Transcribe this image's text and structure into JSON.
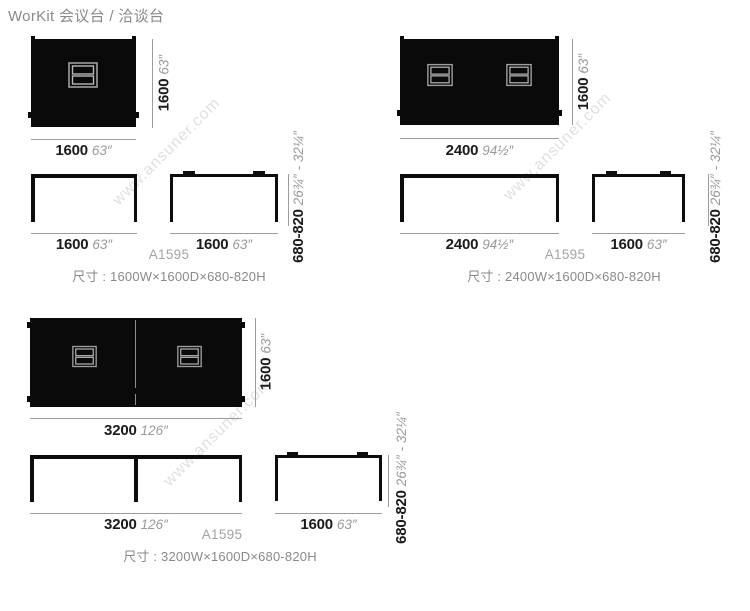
{
  "page_title": "WorKit 会议台 / 洽谈台",
  "watermark": "www.ansuner.com",
  "colors": {
    "table_black": "#0a0a0a",
    "dim_number": "#1b1b1b",
    "dim_inches_gray": "#9a9a9a",
    "dim_line_gray": "#9c9c9c",
    "label_gray": "#8a8a8a",
    "model_gray": "#a5a2a2",
    "port_stroke": "#9f9f9f"
  },
  "products": [
    {
      "model": "A1595",
      "spec": "尺寸 : 1600W×1600D×680-820H",
      "top": {
        "width_mm": "1600",
        "width_in": "63″",
        "depth_mm": "1600",
        "depth_in": "63″"
      },
      "front": {
        "width_mm": "1600",
        "width_in": "63″"
      },
      "side": {
        "width_mm": "1600",
        "width_in": "63″"
      },
      "height": {
        "mm": "680-820",
        "in": "26¾″ - 32¼″"
      }
    },
    {
      "model": "A1595",
      "spec": "尺寸 : 2400W×1600D×680-820H",
      "top": {
        "width_mm": "2400",
        "width_in": "94½″",
        "depth_mm": "1600",
        "depth_in": "63″"
      },
      "front": {
        "width_mm": "2400",
        "width_in": "94½″"
      },
      "side": {
        "width_mm": "1600",
        "width_in": "63″"
      },
      "height": {
        "mm": "680-820",
        "in": "26¾″ - 32¼″"
      }
    },
    {
      "model": "A1595",
      "spec": "尺寸 : 3200W×1600D×680-820H",
      "top": {
        "width_mm": "3200",
        "width_in": "126″",
        "depth_mm": "1600",
        "depth_in": "63″"
      },
      "front": {
        "width_mm": "3200",
        "width_in": "126″"
      },
      "side": {
        "width_mm": "1600",
        "width_in": "63″"
      },
      "height": {
        "mm": "680-820",
        "in": "26¾″ - 32¼″"
      }
    }
  ]
}
